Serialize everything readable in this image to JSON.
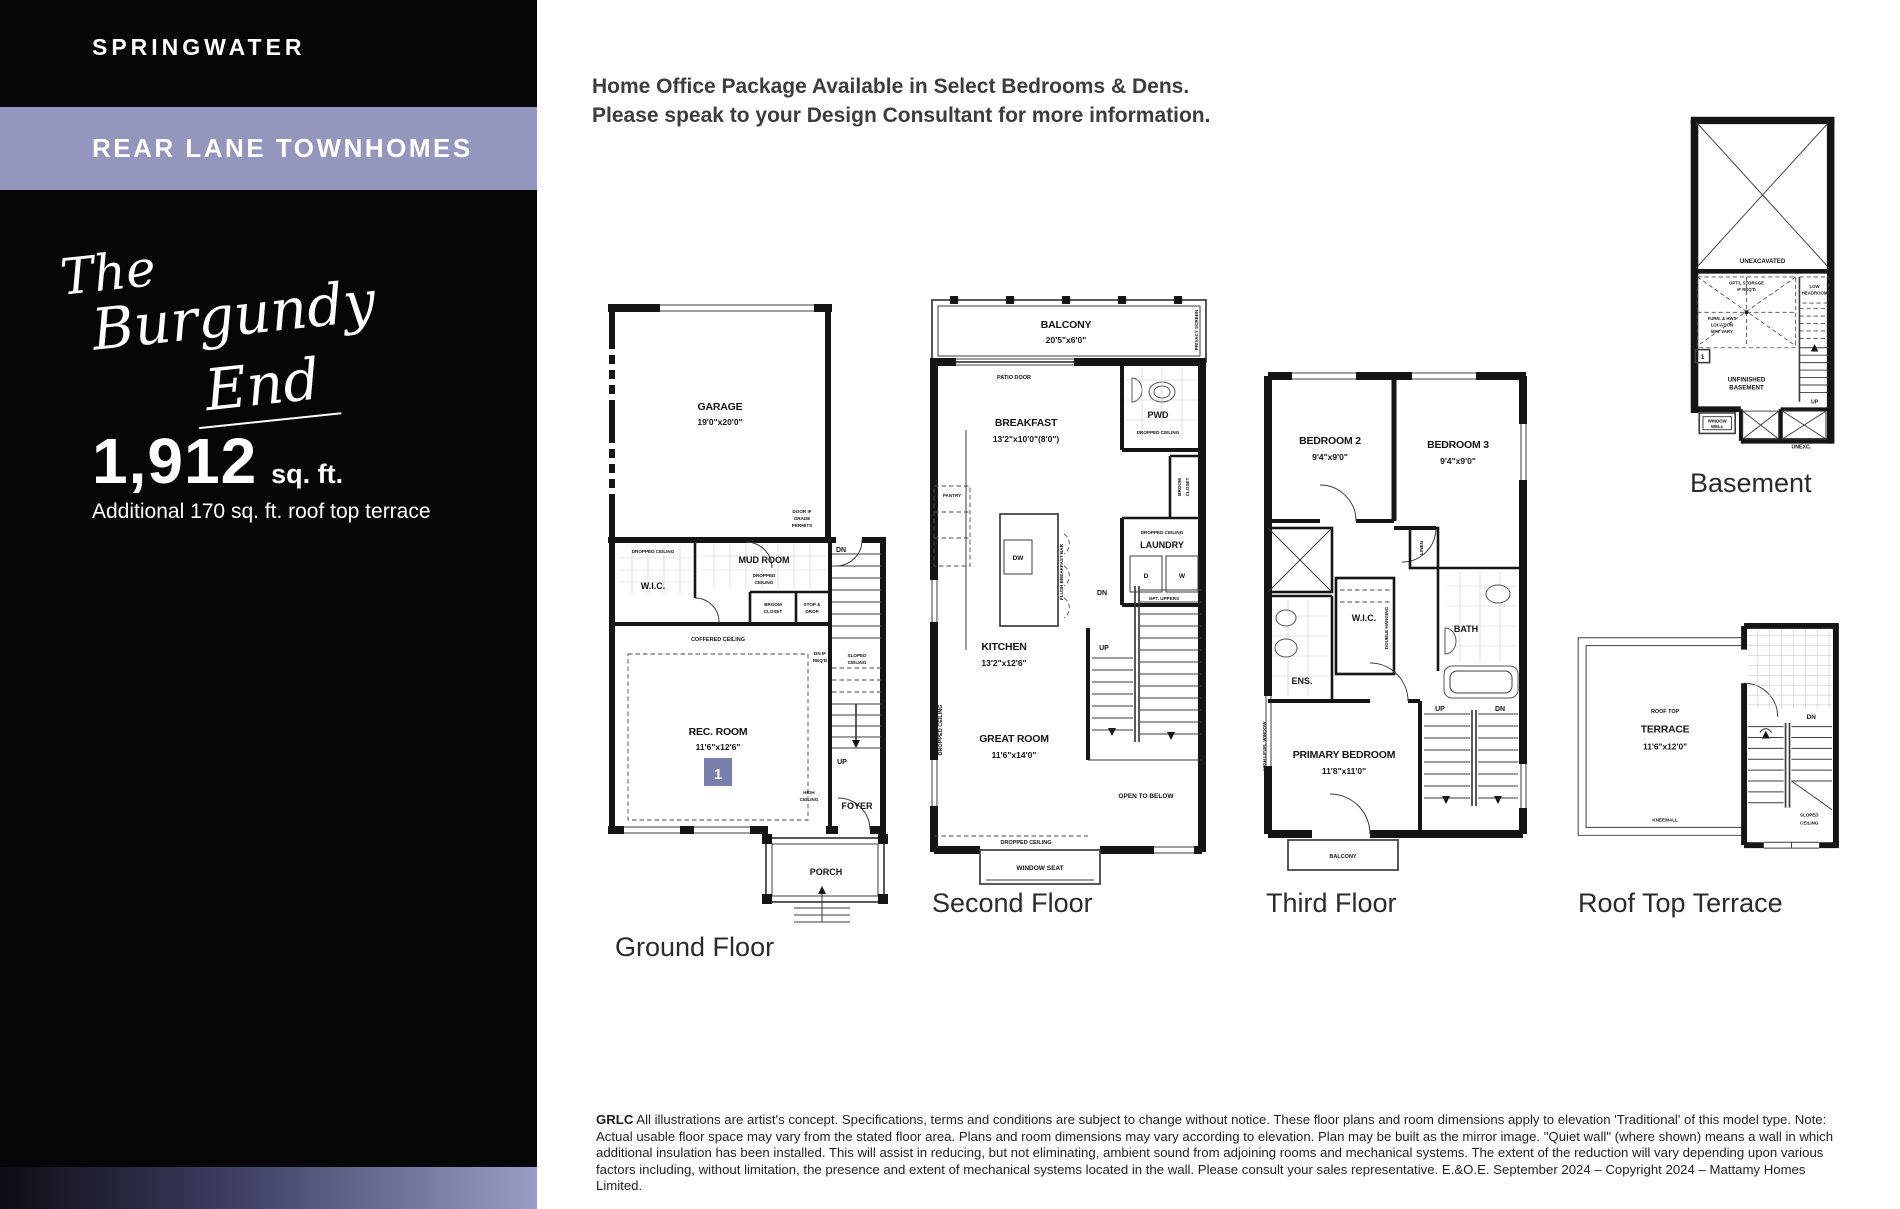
{
  "sidebar": {
    "community": "SPRINGWATER",
    "product": "REAR LANE TOWNHOMES",
    "model_line1": "The",
    "model_line2": "Burgundy",
    "model_line3": "End",
    "sqft": "1,912",
    "sqft_unit": "sq. ft.",
    "additional": "Additional 170 sq. ft. roof top terrace"
  },
  "header": {
    "line1": "Home Office Package Available in Select Bedrooms & Dens.",
    "line2": "Please speak to your Design Consultant for more information."
  },
  "common": {
    "dropped_ceiling": "DROPPED CEILING",
    "dropped": "DROPPED",
    "ceiling": "CEILING",
    "coffered_ceiling": "COFFERED CEILING",
    "sloped": "SLOPED",
    "dn": "DN",
    "up": "UP",
    "balcony": "BALCONY",
    "wic": "W.I.C.",
    "linen": "LINEN",
    "broom": "BROOM",
    "closet": "CLOSET"
  },
  "ground": {
    "title": "Ground Floor",
    "garage": "GARAGE",
    "garage_dims": "19'0\"x20'0\"",
    "door_grade_l1": "DOOR IF",
    "door_grade_l2": "GRADE",
    "door_grade_l3": "PERMITS",
    "mud_room": "MUD ROOM",
    "stop_l1": "STOP &",
    "stop_l2": "DROP",
    "rec_room": "REC. ROOM",
    "rec_dims": "11'6\"x12'6\"",
    "marker": "1",
    "dn_req_l1": "DN IF",
    "dn_req_l2": "REQ'D",
    "high_l1": "HIGH",
    "high_l2": "CEILING",
    "foyer": "FOYER",
    "porch": "PORCH"
  },
  "second": {
    "title": "Second Floor",
    "balcony_dims": "20'5\"x6'0\"",
    "privacy_screen": "PRIVACY SCREEN",
    "patio_door": "PATIO DOOR",
    "breakfast": "BREAKFAST",
    "breakfast_dims": "13'2\"x10'0\"(8'0\")",
    "pwd": "PWD",
    "laundry": "LAUNDRY",
    "d": "D",
    "w": "W",
    "opt_uppers": "OPT. UPPERS",
    "pantry": "PANTRY",
    "dw": "DW",
    "flush_bar": "FLUSH BREAKFAST BAR",
    "kitchen": "KITCHEN",
    "kitchen_dims": "13'2\"x12'6\"",
    "great_room": "GREAT ROOM",
    "great_dims": "11'6\"x14'0\"",
    "open_below": "OPEN TO BELOW",
    "window_seat": "WINDOW SEAT"
  },
  "third": {
    "title": "Third Floor",
    "bedroom2": "BEDROOM 2",
    "bedroom2_dims": "9'4\"x9'0\"",
    "bedroom3": "BEDROOM 3",
    "bedroom3_dims": "9'4\"x9'0\"",
    "ens": "ENS.",
    "bath": "BATH",
    "double_hanging": "DOUBLE HANGING",
    "high_level_window": "HIGH LEVEL WINDOW",
    "primary": "PRIMARY BEDROOM",
    "primary_dims": "11'8\"x11'0\""
  },
  "basement": {
    "title": "Basement",
    "unexcavated": "UNEXCAVATED",
    "note1_l1": "OPT'L STORAGE",
    "note1_l2": "IF REQ'D",
    "note2_l1": "FURN. & HWT",
    "note2_l2": "LOCATION",
    "note2_l3": "MAY VARY",
    "low_l1": "LOW",
    "low_l2": "HEADROOM",
    "marker": "1",
    "unfinished_l1": "UNFINISHED",
    "unfinished_l2": "BASEMENT",
    "window_well_l1": "WINDOW",
    "window_well_l2": "WELL",
    "unexc": "UNEXC."
  },
  "roof": {
    "title": "Roof Top Terrace",
    "rooftop": "ROOF TOP",
    "terrace": "TERRACE",
    "terrace_dims": "11'6\"x12'0\"",
    "kneewall": "KNEEWALL"
  },
  "footer": {
    "bold": "GRLC",
    "text": " All illustrations are artist's concept. Specifications, terms and conditions are subject to change without notice. These floor plans and room dimensions apply to elevation 'Traditional' of this model type. Note: Actual usable floor space may vary from the stated floor area. Plans and room dimensions may vary according to elevation. Plan may be built as the mirror image. \"Quiet wall\" (where shown) means a wall in which additional insulation has been installed. This will assist in reducing, but not eliminating, ambient sound from adjoining rooms and mechanical systems. The extent of the reduction will vary depending upon various factors including, without limitation, the presence and extent of mechanical systems located in the wall. Please consult your sales representative. E.&O.E. September 2024 – Copyright 2024 – Mattamy Homes Limited."
  },
  "colors": {
    "accent_band": "#9496BE",
    "marker_box": "#7A7EAC",
    "sidebar_bg": "#060607",
    "wall_ink": "#151515"
  }
}
